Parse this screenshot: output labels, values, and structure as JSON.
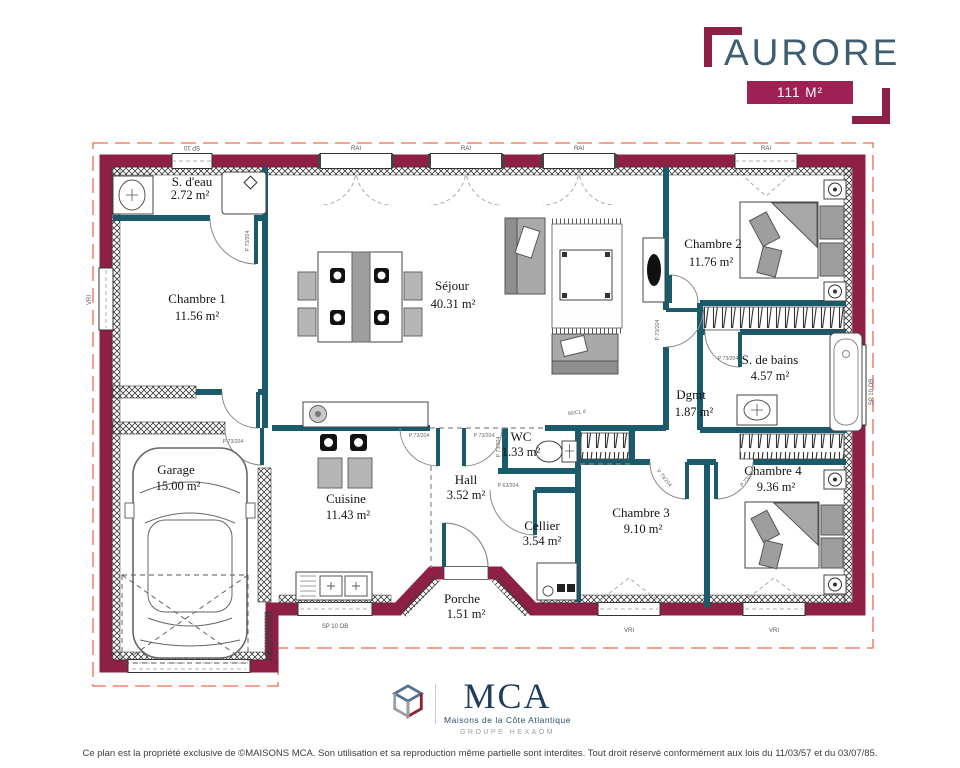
{
  "header": {
    "title": "AURORE",
    "badge": "111 M²"
  },
  "rooms": {
    "sdeau": {
      "name": "S. d'eau",
      "area": "2.72 m²"
    },
    "chambre1": {
      "name": "Chambre 1",
      "area": "11.56 m²"
    },
    "sejour": {
      "name": "Séjour",
      "area": "40.31 m²"
    },
    "chambre2": {
      "name": "Chambre 2",
      "area": "11.76 m²"
    },
    "sdb": {
      "name": "S. de bains",
      "area": "4.57 m²"
    },
    "dgmt": {
      "name": "Dgmt",
      "area": "1.87 m²"
    },
    "wc": {
      "name": "WC",
      "area": "1.33 m²"
    },
    "hall": {
      "name": "Hall",
      "area": "3.52 m²"
    },
    "cuisine": {
      "name": "Cuisine",
      "area": "11.43 m²"
    },
    "cellier": {
      "name": "Cellier",
      "area": "3.54 m²"
    },
    "chambre3": {
      "name": "Chambre 3",
      "area": "9.10 m²"
    },
    "chambre4": {
      "name": "Chambre 4",
      "area": "9.36 m²"
    },
    "garage": {
      "name": "Garage",
      "area": "15.00 m²"
    },
    "porche": {
      "name": "Porche",
      "area": "1.51 m²"
    }
  },
  "openings": {
    "sp10": "SP 10",
    "sp10ob": "SP 10 OB",
    "rai": "RAI",
    "vri": "VRI",
    "p73": "P 73/204",
    "p63": "P 63/204",
    "p90": "90/CL d"
  },
  "logo": {
    "name": "MCA",
    "subtitle": "Maisons de la Côte Atlantique",
    "group": "GROUPE HEXAÖM"
  },
  "footer": {
    "copyright": "Ce plan est la propriété exclusive de ©MAISONS MCA. Son utilisation et sa reproduction même partielle sont interdites. Tout droit réservé conformément aux lois du 11/03/57 et du 03/07/85."
  },
  "colors": {
    "wall": "#8e2045",
    "partition": "#1a5a6b",
    "accent": "#9d2154",
    "title": "#3e5d70",
    "navy": "#1e3c5f",
    "dash": "#ef6a4f"
  }
}
